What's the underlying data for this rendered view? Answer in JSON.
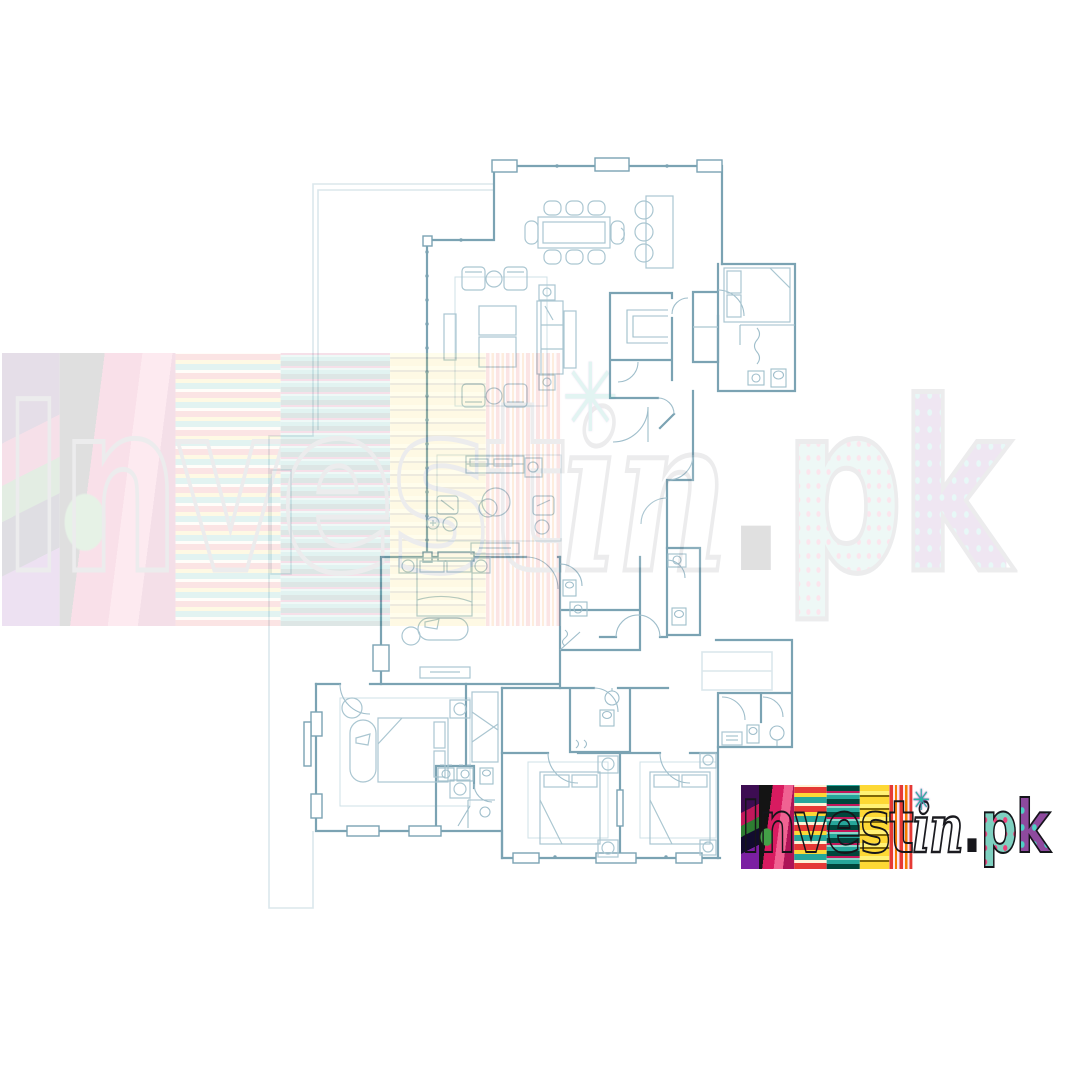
{
  "page": {
    "background": "#ffffff"
  },
  "floor_plan": {
    "kind": "residential-apartment-floor-plan-line-drawing",
    "wall_color": "#7ba3b3",
    "furniture_color": "#aac6d1",
    "balcony_color": "#dbe7ec",
    "door_color": "#9fbecb"
  },
  "watermark": {
    "text": "Investin.pk",
    "opacity": "0.13"
  },
  "brand": {
    "name": "Investin.pk",
    "star_glyph": "✳",
    "letters": [
      {
        "text": "I"
      },
      {
        "text": "n"
      },
      {
        "text": "v"
      },
      {
        "text": "e"
      },
      {
        "text": "s"
      },
      {
        "text": "t"
      },
      {
        "text": "in"
      },
      {
        "text": "."
      },
      {
        "text": "p"
      },
      {
        "text": "k"
      }
    ],
    "palette": [
      "#7b1fa2",
      "#e53935",
      "#26a69a",
      "#fdd835",
      "#ec407a",
      "#80cbc4",
      "#141418"
    ]
  }
}
